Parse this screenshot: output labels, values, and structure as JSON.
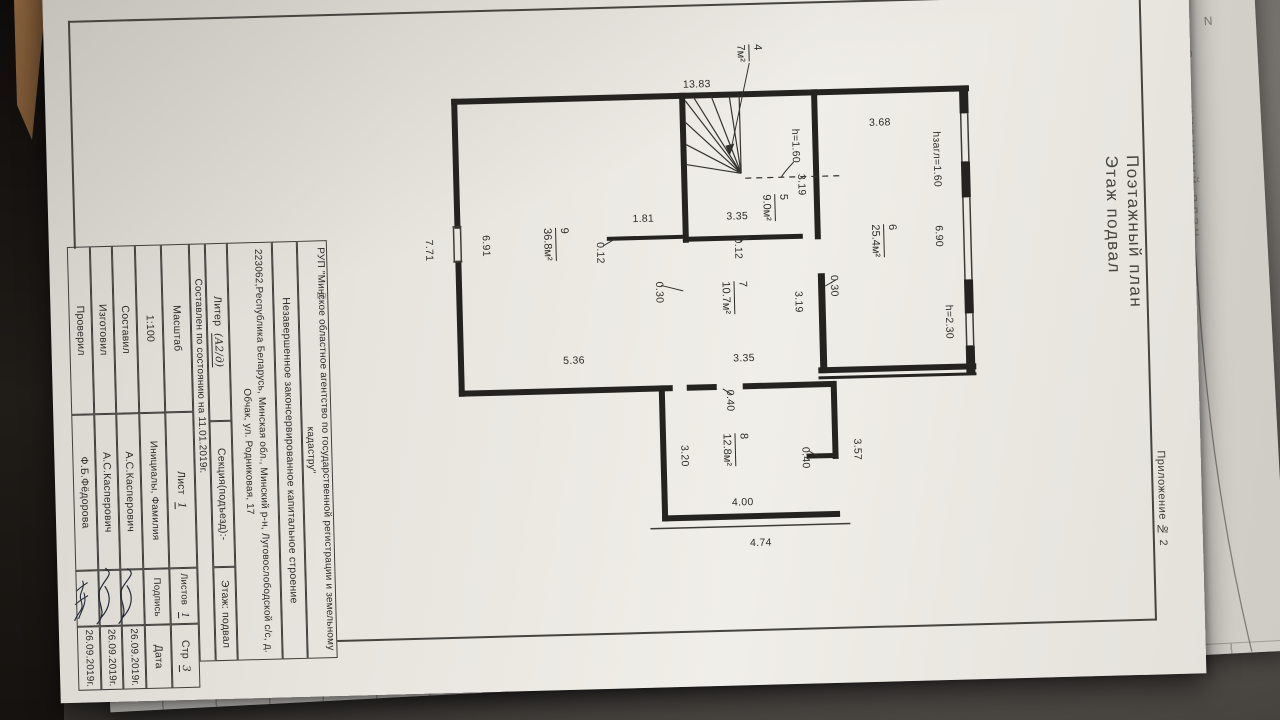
{
  "colors": {
    "paper": "#eae7e1",
    "ink": "#2e2d29",
    "wood": "#8f6740",
    "backdrop": "#514d49"
  },
  "page": {
    "attachment": "Приложение № 2",
    "title_line1": "Поэтажный план",
    "title_line2": "Этаж подвал",
    "ghost_title": "Ситуационный план",
    "north_mark": "N",
    "margin_note": "№"
  },
  "plan": {
    "rooms": [
      {
        "num": "4",
        "area": "7м²",
        "x": 757,
        "y": 56
      },
      {
        "num": "5",
        "area": "9.0м²",
        "x": 779,
        "y": 211
      },
      {
        "num": "6",
        "area": "25.4м²",
        "x": 887,
        "y": 247
      },
      {
        "num": "7",
        "area": "10.7м²",
        "x": 736,
        "y": 300
      },
      {
        "num": "8",
        "area": "12.8м²",
        "x": 733,
        "y": 452
      },
      {
        "num": "9",
        "area": "36.8м²",
        "x": 559,
        "y": 242
      }
    ],
    "dims_h": [
      {
        "t": "13.83",
        "x": 704,
        "y": 86
      },
      {
        "t": "3.68",
        "x": 886,
        "y": 129
      },
      {
        "t": "1.81",
        "x": 647,
        "y": 219
      },
      {
        "t": "3.35",
        "x": 741,
        "y": 219
      },
      {
        "t": "5.36",
        "x": 574,
        "y": 359
      },
      {
        "t": "3.35",
        "x": 744,
        "y": 361
      },
      {
        "t": "4.00",
        "x": 739,
        "y": 505
      },
      {
        "t": "4.74",
        "x": 756,
        "y": 546
      }
    ],
    "dims_v": [
      {
        "t": "hзагл=1.60",
        "x": 942,
        "y": 167
      },
      {
        "t": "6.90",
        "x": 942,
        "y": 244
      },
      {
        "t": "h=2.30",
        "x": 950,
        "y": 330
      },
      {
        "t": "h=1.60",
        "x": 801,
        "y": 150
      },
      {
        "t": "3.19",
        "x": 806,
        "y": 189
      },
      {
        "t": "0.12",
        "x": 603,
        "y": 252
      },
      {
        "t": "0.12",
        "x": 741,
        "y": 251
      },
      {
        "t": "6.91",
        "x": 489,
        "y": 242
      },
      {
        "t": "7.71",
        "x": 432,
        "y": 245
      },
      {
        "t": "0.30",
        "x": 661,
        "y": 293
      },
      {
        "t": "0.30",
        "x": 836,
        "y": 291
      },
      {
        "t": "3.19",
        "x": 800,
        "y": 306
      },
      {
        "t": "0.40",
        "x": 729,
        "y": 403
      },
      {
        "t": "3.20",
        "x": 682,
        "y": 457
      },
      {
        "t": "0.40",
        "x": 803,
        "y": 462
      },
      {
        "t": "3.57",
        "x": 855,
        "y": 455
      }
    ]
  },
  "title_block": {
    "org": "РУП \"Минское областное агентство по государственной регистрации и земельному кадастру\"",
    "object": "Незавершенное законсервированное капитальное строение",
    "address": "223062,Республика Беларусь, Минская обл., Минский р-н, Луговослободской с/с, д. Обчак, ул. Родниковая, 17",
    "liter_label": "Литер",
    "liter_value": "(А2/д)",
    "section": "Секция(подъезд):-",
    "floor": "Этаж: подвал",
    "compiled": "Составлен по состоянию на 11.01.2019г.",
    "scale_label": "Масштаб",
    "scale_value": "1:100",
    "sheet_label": "Лист",
    "sheet_value": "1",
    "sheets_label": "Листов",
    "sheets_value": "1",
    "page_label": "Стр",
    "page_value": "3",
    "initials_header": "Инициалы, Фамилия",
    "signature_header": "Подпись",
    "date_header": "Дата",
    "rows": [
      {
        "role": "Составил",
        "name": "А.С.Касперович",
        "date": "26.09.2019г."
      },
      {
        "role": "Изготовил",
        "name": "А.С.Касперович",
        "date": "26.09.2019г."
      },
      {
        "role": "Проверил",
        "name": "Ф.Б.Фёдорова",
        "date": "26.09.2019г."
      }
    ]
  }
}
